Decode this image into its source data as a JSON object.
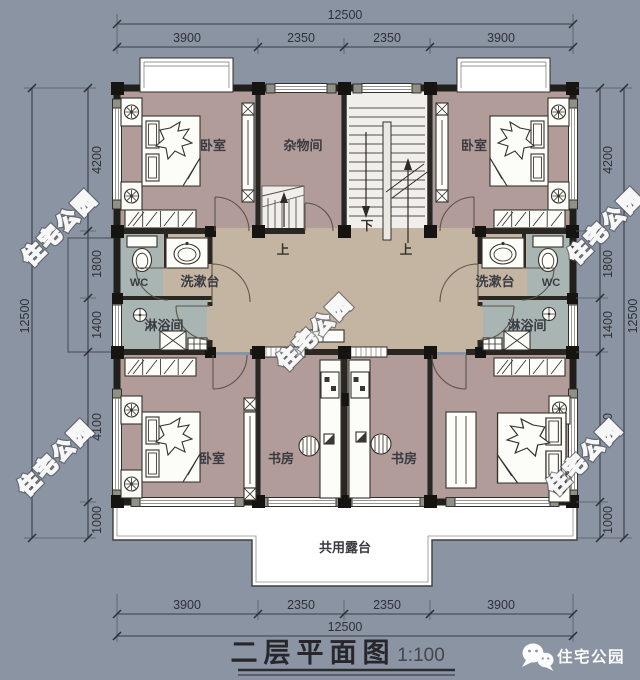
{
  "colors": {
    "background": "#8a94a2",
    "bedroom_floor": "#b29c99",
    "hall_floor": "#c4b5a3",
    "bath_floor": "#a8b5b3",
    "stair_floor": "#f0efeb",
    "wall": "#211f1c",
    "terrace": "#ffffff",
    "watermark": "#f7f7f7"
  },
  "title": {
    "text": "二层平面图",
    "scale": "1:100"
  },
  "brand": {
    "name": "住宅公园"
  },
  "watermark": {
    "text": "住宅公园"
  },
  "rooms": {
    "bedroom_tl": "卧室",
    "storage": "杂物间",
    "bedroom_tr": "卧室",
    "wc_left": "WC",
    "wash_left": "洗漱台",
    "shower_left": "淋浴间",
    "wash_right": "洗漱台",
    "wc_right": "WC",
    "shower_right": "淋浴间",
    "bedroom_bl": "卧室",
    "study_left": "书房",
    "study_right": "书房",
    "terrace": "共用露台",
    "up_left": "上",
    "up_right": "上",
    "down": "下"
  },
  "dimensions": {
    "top": {
      "overall": "12500",
      "segments": [
        "3900",
        "2350",
        "2350",
        "3900"
      ]
    },
    "bottom": {
      "overall": "12500",
      "segments": [
        "3900",
        "2350",
        "2350",
        "3900"
      ]
    },
    "left": {
      "overall": "12500",
      "segments": [
        "4200",
        "1800",
        "1400",
        "4100",
        "1000"
      ]
    },
    "right": {
      "overall": "12500",
      "segments": [
        "4200",
        "1800",
        "1400",
        "4100",
        "1000"
      ]
    }
  }
}
